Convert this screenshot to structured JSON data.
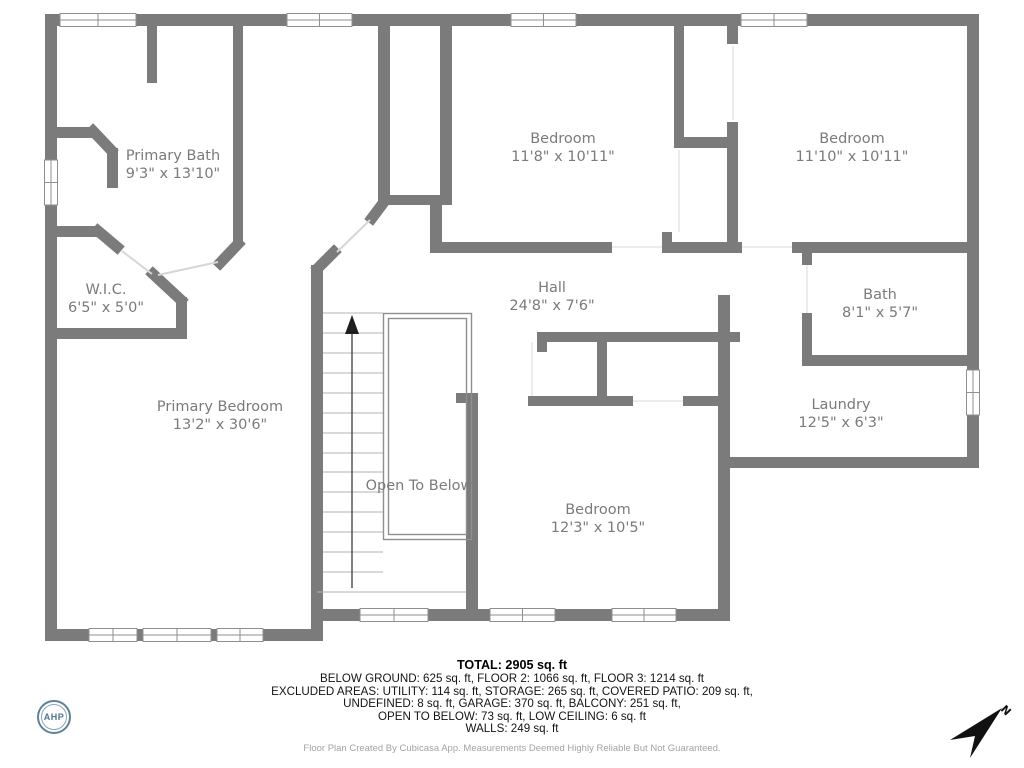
{
  "plan": {
    "rooms": [
      {
        "id": "primary-bath",
        "name": "Primary Bath",
        "dims": "9'3\" x 13'10\""
      },
      {
        "id": "wic",
        "name": "W.I.C.",
        "dims": "6'5\" x 5'0\""
      },
      {
        "id": "primary-bedroom",
        "name": "Primary Bedroom",
        "dims": "13'2\" x 30'6\""
      },
      {
        "id": "bedroom-top-middle",
        "name": "Bedroom",
        "dims": "11'8\" x 10'11\""
      },
      {
        "id": "bedroom-top-right",
        "name": "Bedroom",
        "dims": "11'10\" x 10'11\""
      },
      {
        "id": "hall",
        "name": "Hall",
        "dims": "24'8\" x 7'6\""
      },
      {
        "id": "bath",
        "name": "Bath",
        "dims": "8'1\" x 5'7\""
      },
      {
        "id": "laundry",
        "name": "Laundry",
        "dims": "12'5\" x 6'3\""
      },
      {
        "id": "bedroom-bottom",
        "name": "Bedroom",
        "dims": "12'3\" x 10'5\""
      }
    ],
    "open_to_below_label": "Open To Below"
  },
  "footer": {
    "total": "TOTAL: 2905 sq. ft",
    "line1": "BELOW GROUND: 625 sq. ft, FLOOR 2: 1066 sq. ft, FLOOR 3: 1214 sq. ft",
    "line2": "EXCLUDED AREAS: UTILITY: 114 sq. ft, STORAGE: 265 sq. ft, COVERED PATIO: 209 sq. ft,",
    "line3": "UNDEFINED: 8 sq. ft, GARAGE: 370 sq. ft, BALCONY: 251 sq. ft,",
    "line4": "OPEN TO BELOW: 73 sq. ft, LOW CEILING: 6 sq. ft",
    "line5": "WALLS: 249 sq. ft",
    "credit": "Floor Plan Created By Cubicasa App. Measurements Deemed Highly Reliable But Not Guaranteed."
  },
  "logo": {
    "text": "AHP"
  },
  "compass": {
    "label": "N"
  },
  "colors": {
    "wall": "#7b7b7b",
    "label": "#7b7b7b",
    "logo_ring": "#5d8198"
  }
}
